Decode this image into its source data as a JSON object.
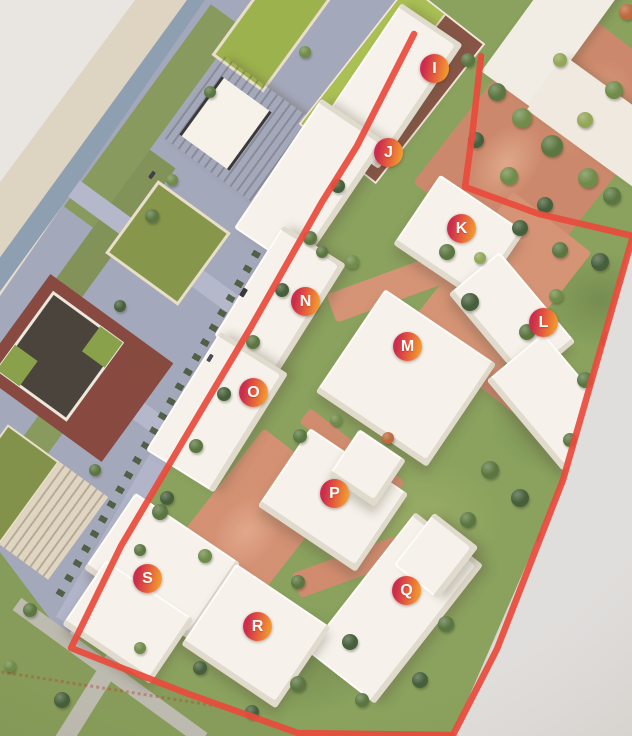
{
  "scene": {
    "type": "architectural-site-model-photo",
    "marker_letters_visible": [
      "I",
      "J",
      "K",
      "L",
      "M",
      "N",
      "O",
      "P",
      "Q",
      "R",
      "S"
    ]
  },
  "markers": [
    {
      "label": "I"
    },
    {
      "label": "J"
    },
    {
      "label": "K"
    },
    {
      "label": "L"
    },
    {
      "label": "M"
    },
    {
      "label": "N"
    },
    {
      "label": "O"
    },
    {
      "label": "P"
    },
    {
      "label": "Q"
    },
    {
      "label": "R"
    },
    {
      "label": "S"
    }
  ],
  "colors": {
    "boundary_line": "#e8392b",
    "marker_gradient_start": "#c8173e",
    "marker_gradient_end": "#ef8f1d",
    "marker_text": "#ffffff",
    "lawn_green": "#7e9a50",
    "plaza_terracotta": "#cd8163",
    "canal_blue": "#8297ad",
    "street_lavender": "#a9adc6",
    "model_base_grey": "#dedddc",
    "brick_red_tower": "#7c392f",
    "green_roof": "#93ac3e",
    "white_building": "#f6f3ed"
  }
}
